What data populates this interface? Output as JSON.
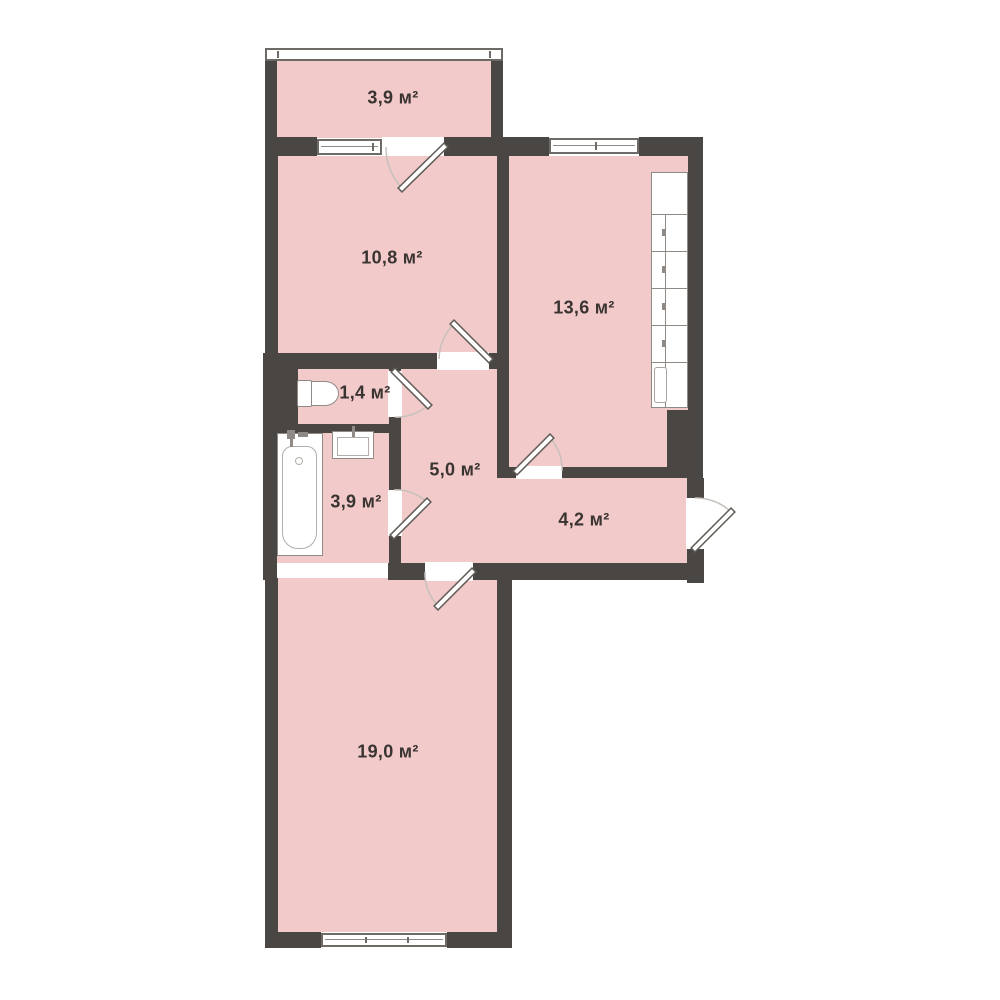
{
  "floor_plan": {
    "unit_suffix": "м²",
    "rooms": [
      {
        "name": "balcony",
        "area_label": "3,9 м²"
      },
      {
        "name": "room-10-8",
        "area_label": "10,8 м²"
      },
      {
        "name": "kitchen",
        "area_label": "13,6 м²"
      },
      {
        "name": "wc",
        "area_label": "1,4 м²"
      },
      {
        "name": "hallway",
        "area_label": "5,0 м²"
      },
      {
        "name": "bathroom",
        "area_label": "3,9 м²"
      },
      {
        "name": "entrance-hall",
        "area_label": "4,2 м²"
      },
      {
        "name": "room-19-0",
        "area_label": "19,0 м²"
      }
    ],
    "fixtures": [
      "kitchen-cabinets",
      "toilet",
      "bathtub",
      "sink"
    ],
    "colors": {
      "wall": "#4a4643",
      "floor": "#f2caca",
      "background": "#ffffff",
      "label_text": "#393431",
      "fixture_border": "#8f8a86",
      "door_arc": "#c6c1bd"
    }
  }
}
